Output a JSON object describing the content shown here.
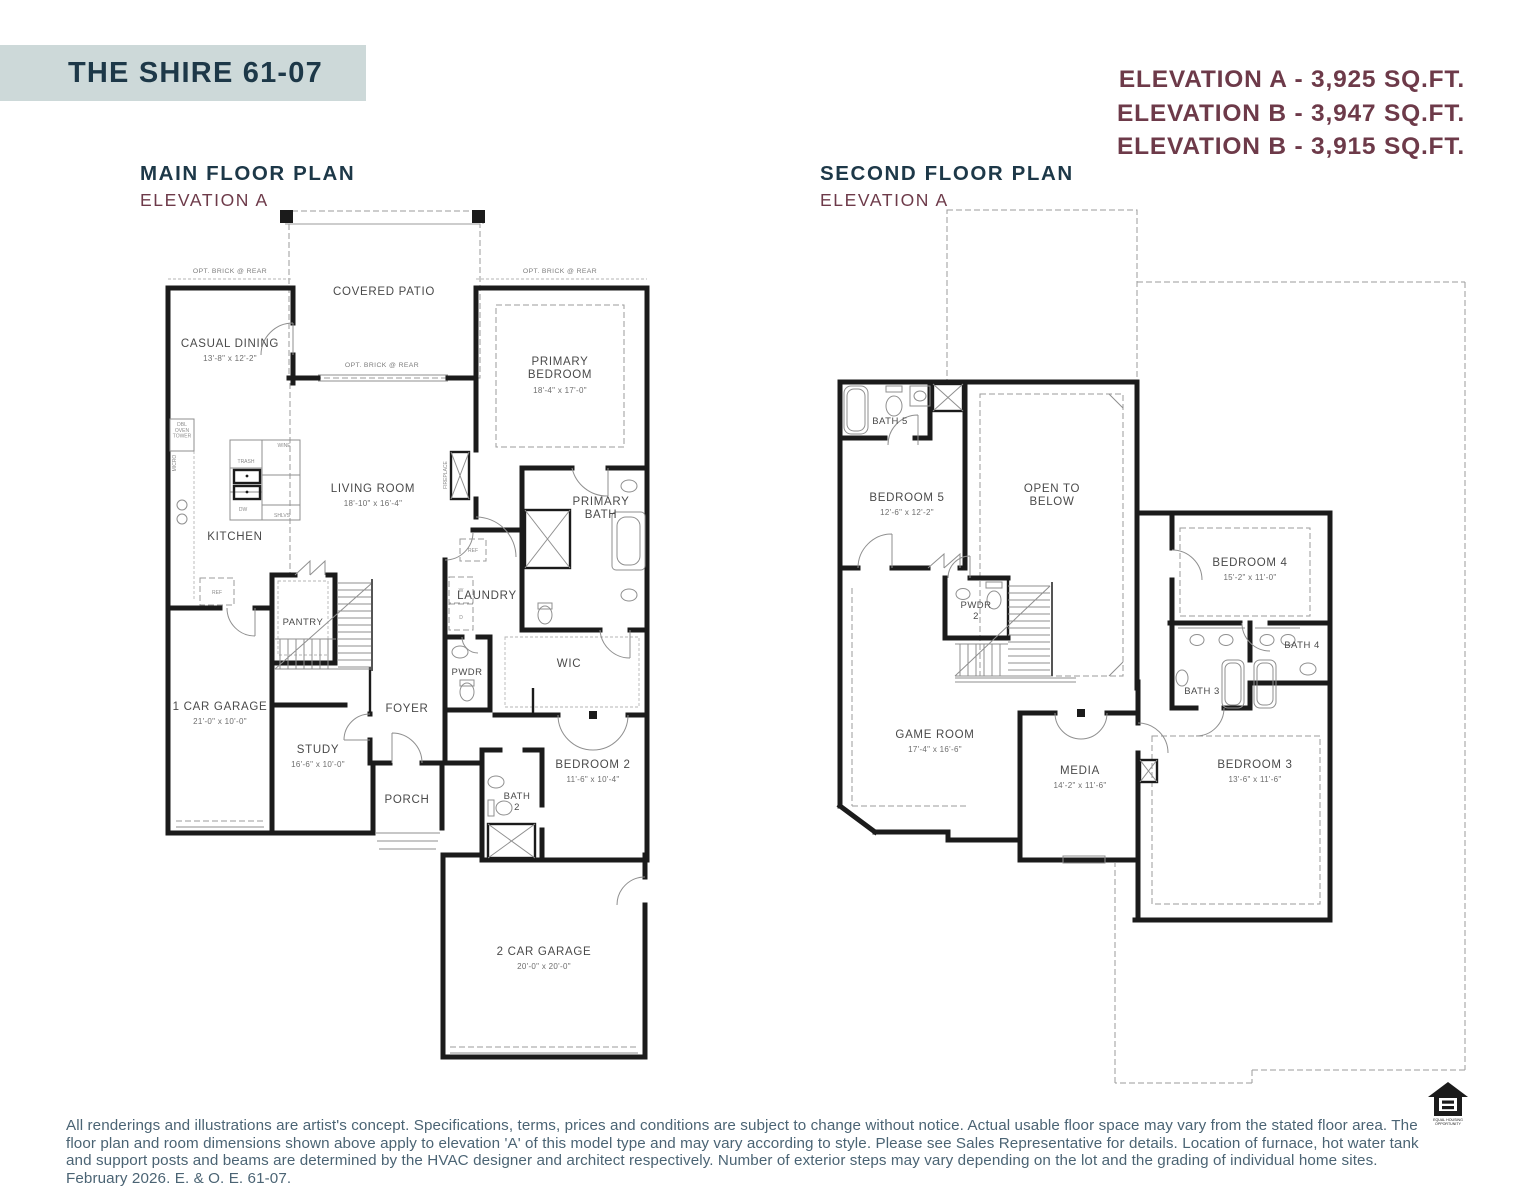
{
  "page": {
    "title": "THE SHIRE 61-07",
    "elevations": [
      "ELEVATION A - 3,925 SQ.FT.",
      "ELEVATION B - 3,947 SQ.FT.",
      "ELEVATION B - 3,915 SQ.FT."
    ],
    "disclaimer": "All renderings and illustrations are artist's concept. Specifications, terms, prices and conditions are subject to change without notice. Actual usable floor space may vary from the stated floor area. The floor plan and room dimensions shown above apply to elevation 'A' of this model type and may vary according to style. Please see Sales Representative for details. Location of furnace, hot water tank and support posts and beams are determined by the HVAC designer and architect respectively. Number of exterior steps may vary depending on the lot and the grading of individual home sites. February 2026. E. & O. E. 61-07.",
    "equal_housing_logo": "EQUAL HOUSING|OPPORTUNITY"
  },
  "colors": {
    "banner_bg": "#cdd9d9",
    "heading_navy": "#1d3848",
    "accent_maroon": "#6d3a49",
    "disclaimer_text": "#4b6474",
    "wall_black": "#1b1b1b"
  },
  "main_floor": {
    "title": "MAIN FLOOR PLAN",
    "subtitle": "ELEVATION A",
    "annotations": {
      "opt_brick": "OPT. BRICK @ REAR",
      "fireplace": "FIREPLACE",
      "dbl_oven_tower": "DBL|OVEN|TOWER",
      "micro": "MICRO",
      "wine": "WINE",
      "trash": "TRASH",
      "dw": "DW",
      "shlvs": "SHLVS",
      "ref": "REF",
      "washer": "W",
      "dryer": "D"
    },
    "rooms": {
      "covered_patio": {
        "name": "COVERED PATIO",
        "dims": ""
      },
      "casual_dining": {
        "name": "CASUAL DINING",
        "dims": "13'-8\" x 12'-2\""
      },
      "primary_bedroom": {
        "name": "PRIMARY|BEDROOM",
        "dims": "18'-4\" x 17'-0\""
      },
      "living_room": {
        "name": "LIVING ROOM",
        "dims": "18'-10\" x 16'-4\""
      },
      "kitchen": {
        "name": "KITCHEN",
        "dims": ""
      },
      "primary_bath": {
        "name": "PRIMARY|BATH",
        "dims": ""
      },
      "laundry": {
        "name": "LAUNDRY",
        "dims": ""
      },
      "pantry": {
        "name": "PANTRY",
        "dims": ""
      },
      "wic": {
        "name": "WIC",
        "dims": ""
      },
      "pwdr": {
        "name": "PWDR",
        "dims": ""
      },
      "foyer": {
        "name": "FOYER",
        "dims": ""
      },
      "study": {
        "name": "STUDY",
        "dims": "16'-6\" x 10'-0\""
      },
      "one_car_garage": {
        "name": "1 CAR GARAGE",
        "dims": "21'-0\" x 10'-0\""
      },
      "porch": {
        "name": "PORCH",
        "dims": ""
      },
      "bath2": {
        "name": "BATH|2",
        "dims": ""
      },
      "bedroom2": {
        "name": "BEDROOM 2",
        "dims": "11'-6\" x 10'-4\""
      },
      "two_car_garage": {
        "name": "2 CAR GARAGE",
        "dims": "20'-0\" x 20'-0\""
      }
    }
  },
  "second_floor": {
    "title": "SECOND FLOOR PLAN",
    "subtitle": "ELEVATION A",
    "rooms": {
      "bath5": {
        "name": "BATH 5",
        "dims": ""
      },
      "bedroom5": {
        "name": "BEDROOM 5",
        "dims": "12'-6\" x 12'-2\""
      },
      "open_to_below": {
        "name": "OPEN TO|BELOW",
        "dims": ""
      },
      "pwdr2": {
        "name": "PWDR|2",
        "dims": ""
      },
      "game_room": {
        "name": "GAME ROOM",
        "dims": "17'-4\" x 16'-6\""
      },
      "media": {
        "name": "MEDIA",
        "dims": "14'-2\" x 11'-6\""
      },
      "bedroom4": {
        "name": "BEDROOM 4",
        "dims": "15'-2\" x 11'-0\""
      },
      "bath3": {
        "name": "BATH 3",
        "dims": ""
      },
      "bath4": {
        "name": "BATH 4",
        "dims": ""
      },
      "bedroom3": {
        "name": "BEDROOM 3",
        "dims": "13'-6\" x 11'-6\""
      }
    }
  }
}
